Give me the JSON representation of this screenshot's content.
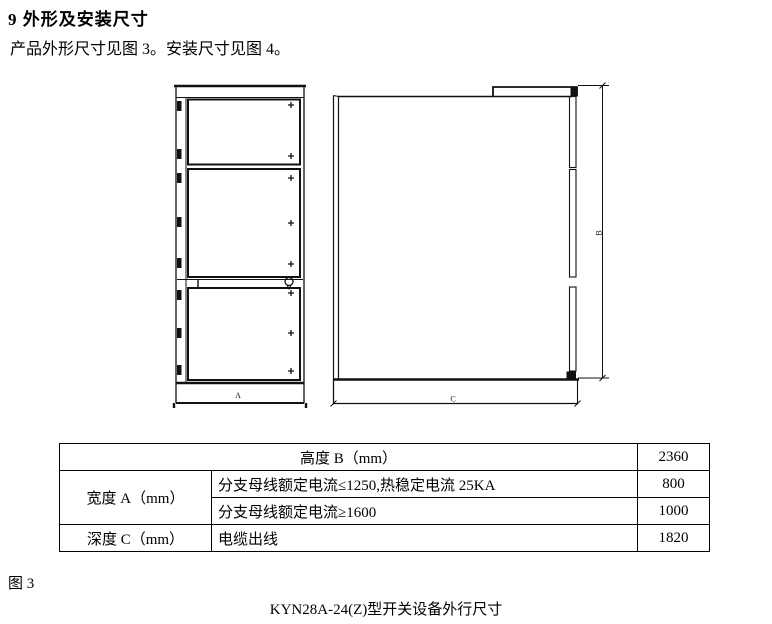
{
  "page": {
    "heading": "9 外形及安装尺寸",
    "intro": "产品外形尺寸见图 3。安装尺寸见图 4。",
    "figure_label": "图 3",
    "caption": "KYN28A-24(Z)型开关设备外行尺寸"
  },
  "drawing": {
    "dim_width_label": "A",
    "dim_height_label": "B",
    "dim_depth_label": "C"
  },
  "table": {
    "height_row": {
      "label": "高度 B（mm）",
      "value": "2360"
    },
    "width_row": {
      "label": "宽度 A（mm）",
      "case1": {
        "desc": "分支母线额定电流≤1250,热稳定电流 25KA",
        "value": "800"
      },
      "case2": {
        "desc": "分支母线额定电流≥1600",
        "value": "1000"
      }
    },
    "depth_row": {
      "label": "深度 C（mm）",
      "desc": "电缆出线",
      "value": "1820"
    }
  }
}
